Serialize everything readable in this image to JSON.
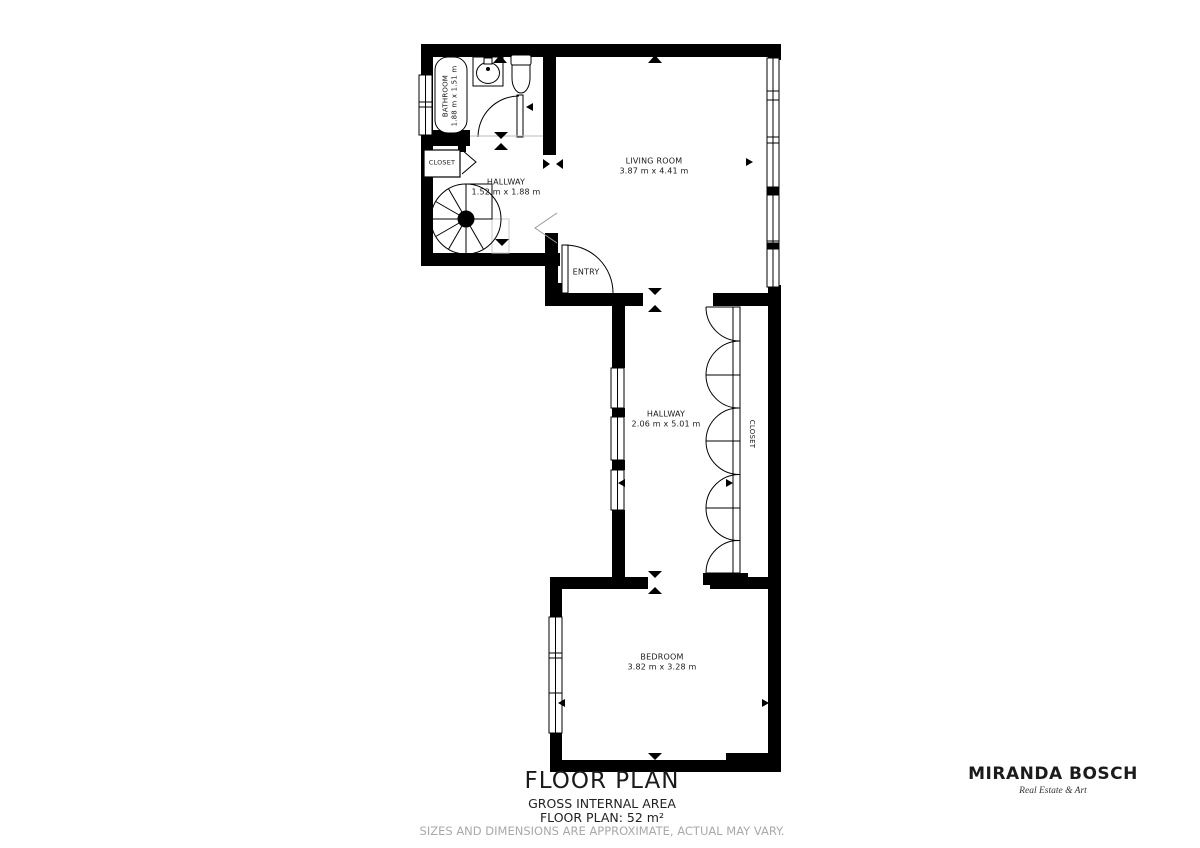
{
  "plan": {
    "rooms": {
      "bathroom": {
        "name": "BATHROOM",
        "dims": "1.88 m x 1.51 m"
      },
      "hall_closet": {
        "name": "CLOSET"
      },
      "hallway_upper": {
        "name": "HALLWAY",
        "dims": "1.52 m x 1.88 m"
      },
      "entry": {
        "name": "ENTRY"
      },
      "living_room": {
        "name": "LIVING ROOM",
        "dims": "3.87 m x 4.41 m"
      },
      "hallway_main": {
        "name": "HALLWAY",
        "dims": "2.06 m x 5.01 m"
      },
      "closet_main": {
        "name": "CLOSET"
      },
      "bedroom": {
        "name": "BEDROOM",
        "dims": "3.82 m x 3.28 m"
      }
    }
  },
  "footer": {
    "title": "FLOOR PLAN",
    "area_heading": "GROSS INTERNAL AREA",
    "area_value": "FLOOR PLAN: 52 m²",
    "disclaimer": "SIZES AND DIMENSIONS ARE APPROXIMATE, ACTUAL MAY VARY."
  },
  "branding": {
    "name": "MIRANDA BOSCH",
    "tagline": "Real Estate & Art"
  },
  "colors": {
    "wall": "#000000",
    "background": "#ffffff",
    "disclaimer_text": "#a9a9a9"
  }
}
